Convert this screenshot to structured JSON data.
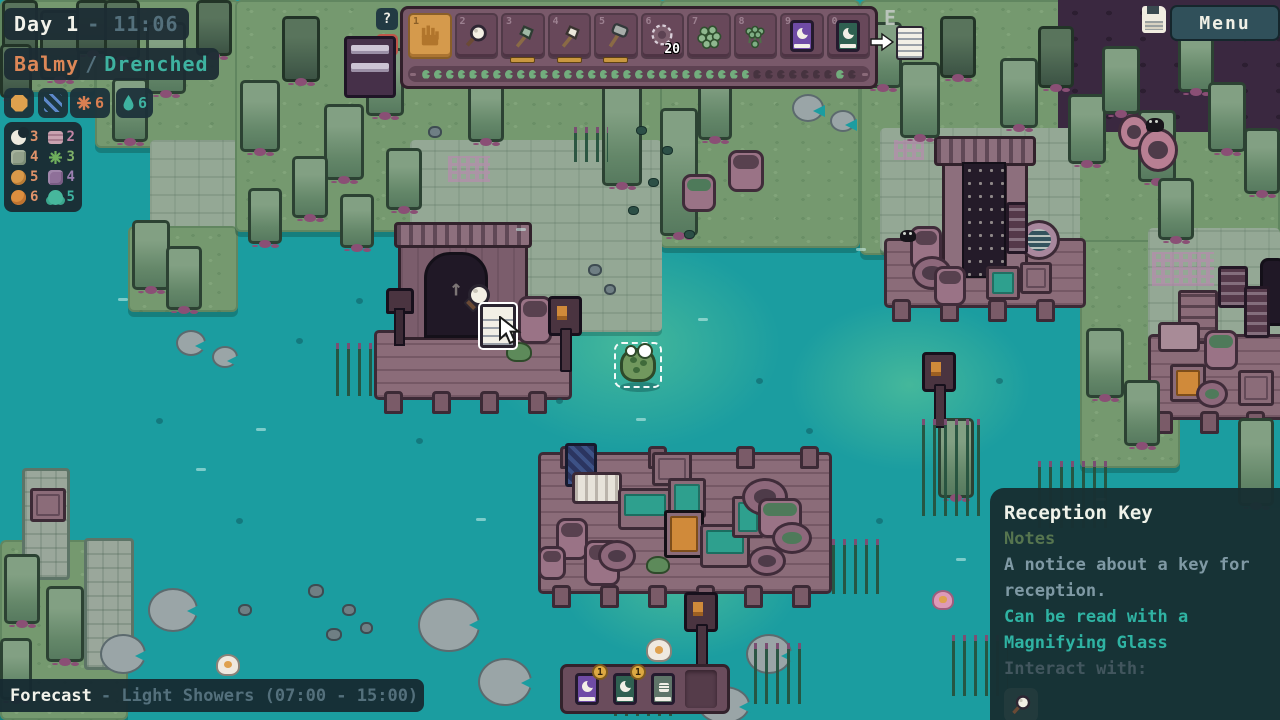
{
  "colors": {
    "water": "#1b9da0",
    "selected_slot": "#d59a4c",
    "panel_bg": "#1c2c34",
    "teal_text": "#3eb2a0",
    "warm_text": "#dd8757"
  },
  "hud": {
    "day": {
      "label": "Day 1",
      "time": "- 11:06"
    },
    "weather": {
      "primary": "Balmy",
      "separator": "/",
      "secondary": "Drenched"
    },
    "condition_badges": [
      {
        "icon": "sun-icon",
        "value": ""
      },
      {
        "icon": "rain-icon",
        "value": ""
      },
      {
        "icon": "temperature-icon",
        "value": "6",
        "color": "#d97f52"
      },
      {
        "icon": "moisture-icon",
        "value": "6",
        "color": "#3eb2a0"
      }
    ],
    "resources": [
      {
        "icon": "moon-item",
        "count": "3",
        "color": "#e0936a"
      },
      {
        "icon": "log-item",
        "count": "2",
        "color": "#c285a5"
      },
      {
        "icon": "moss-item",
        "count": "4",
        "color": "#e0936a"
      },
      {
        "icon": "plant-item",
        "count": "3",
        "color": "#7fb069"
      },
      {
        "icon": "amber-item",
        "count": "5",
        "color": "#e0936a"
      },
      {
        "icon": "purple-moss-item",
        "count": "4",
        "color": "#9b7fb0"
      },
      {
        "icon": "orange-item",
        "count": "6",
        "color": "#e0936a"
      },
      {
        "icon": "teal-item",
        "count": "5",
        "color": "#3eb2a0"
      }
    ]
  },
  "hotbar": {
    "help_label": "?",
    "slots": [
      {
        "num": "1",
        "icon": "hand-icon",
        "selected": true
      },
      {
        "num": "2",
        "icon": "magnifier-icon"
      },
      {
        "num": "3",
        "icon": "hatchet-icon"
      },
      {
        "num": "4",
        "icon": "axe-icon"
      },
      {
        "num": "5",
        "icon": "mallet-icon"
      },
      {
        "num": "6",
        "icon": "net-icon",
        "count": "20"
      },
      {
        "num": "7",
        "icon": "frogspawn-icon"
      },
      {
        "num": "8",
        "icon": "sprout-icon"
      },
      {
        "num": "9",
        "icon": "moon-book-icon"
      },
      {
        "num": "0",
        "icon": "tadpole-book-icon"
      }
    ],
    "dots": {
      "total": 37,
      "lit": 28,
      "late_lit": 35
    }
  },
  "interact_hint": {
    "key": "E",
    "item": "note-icon"
  },
  "top_right": {
    "save_icon": "floppy-icon",
    "menu_label": "Menu"
  },
  "forecast": {
    "label": "Forecast",
    "text": "- Light Showers (07:00 - 15:00)"
  },
  "pocket_bar": {
    "slots": [
      {
        "icon": "moon-book-icon",
        "count": "1"
      },
      {
        "icon": "teal-book-icon",
        "count": "1"
      },
      {
        "icon": "grey-book-icon",
        "count": ""
      },
      {
        "icon": "empty",
        "count": ""
      }
    ]
  },
  "tooltip": {
    "title": "Reception Key",
    "category": "Notes",
    "description": "A notice about a key for reception.",
    "hint": "Can be read with a Magnifying Glass",
    "interact_label": "Interact with:",
    "interact_icon": "magnifier-icon"
  }
}
